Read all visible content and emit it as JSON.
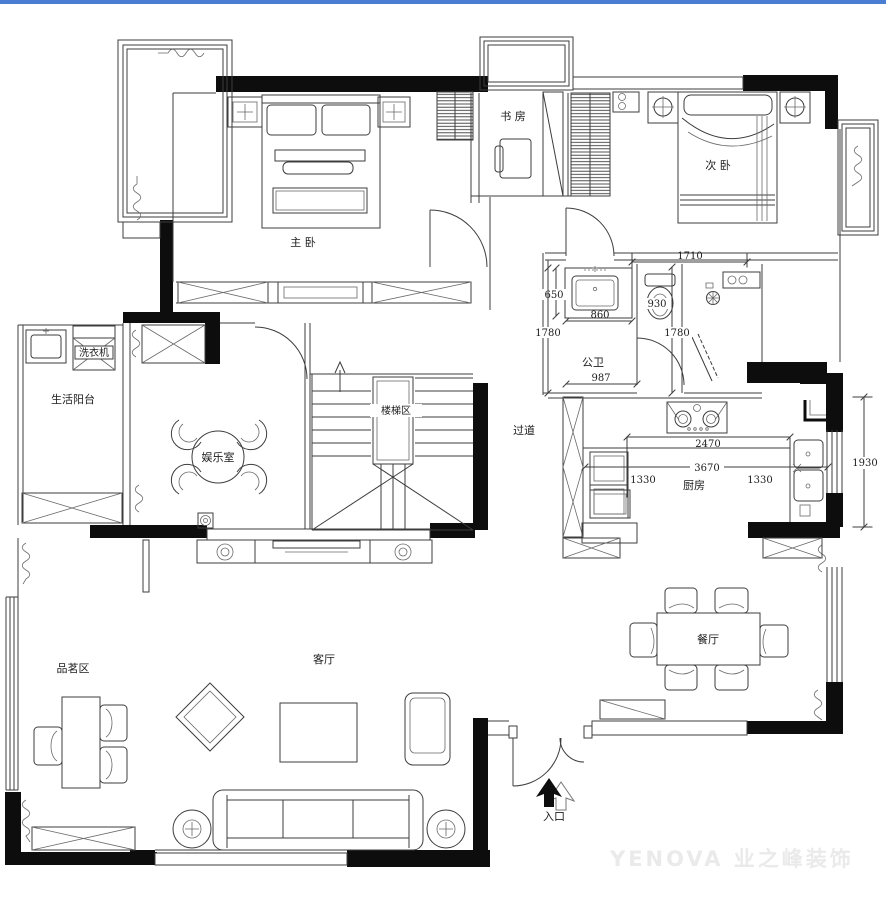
{
  "page": {
    "type": "floor-plan-drawing",
    "colors": {
      "topbar": "#4a7ed2",
      "wall": "#0d0d0d",
      "line": "#3d3d3d",
      "watermark": "#eaeaea"
    }
  },
  "rooms": {
    "master_bedroom": "主 卧",
    "study": "书 房",
    "second_bedroom": "次 卧",
    "washing_machine": "洗衣机",
    "living_balcony": "生活阳台",
    "entertainment_room": "娱乐室",
    "staircase": "楼梯区",
    "corridor": "过道",
    "public_bathroom": "公卫",
    "kitchen": "厨房",
    "dining_room": "餐厅",
    "living_room": "客厅",
    "tea_area": "品茗区",
    "entrance": "入口"
  },
  "dimensions": {
    "bath_zone_width": "1710",
    "vanity_depth": "650",
    "toilet_nook_width": "930",
    "bath_left_height": "1780",
    "vanity_width": "860",
    "shower_height": "1780",
    "bath_inner_width": "987",
    "counter_run": "2470",
    "kitchen_span": "3670",
    "kitchen_left_gap": "1330",
    "kitchen_right_gap": "1330",
    "kitchen_window_height": "1930"
  },
  "watermark": "YENOVA 业之峰装饰"
}
